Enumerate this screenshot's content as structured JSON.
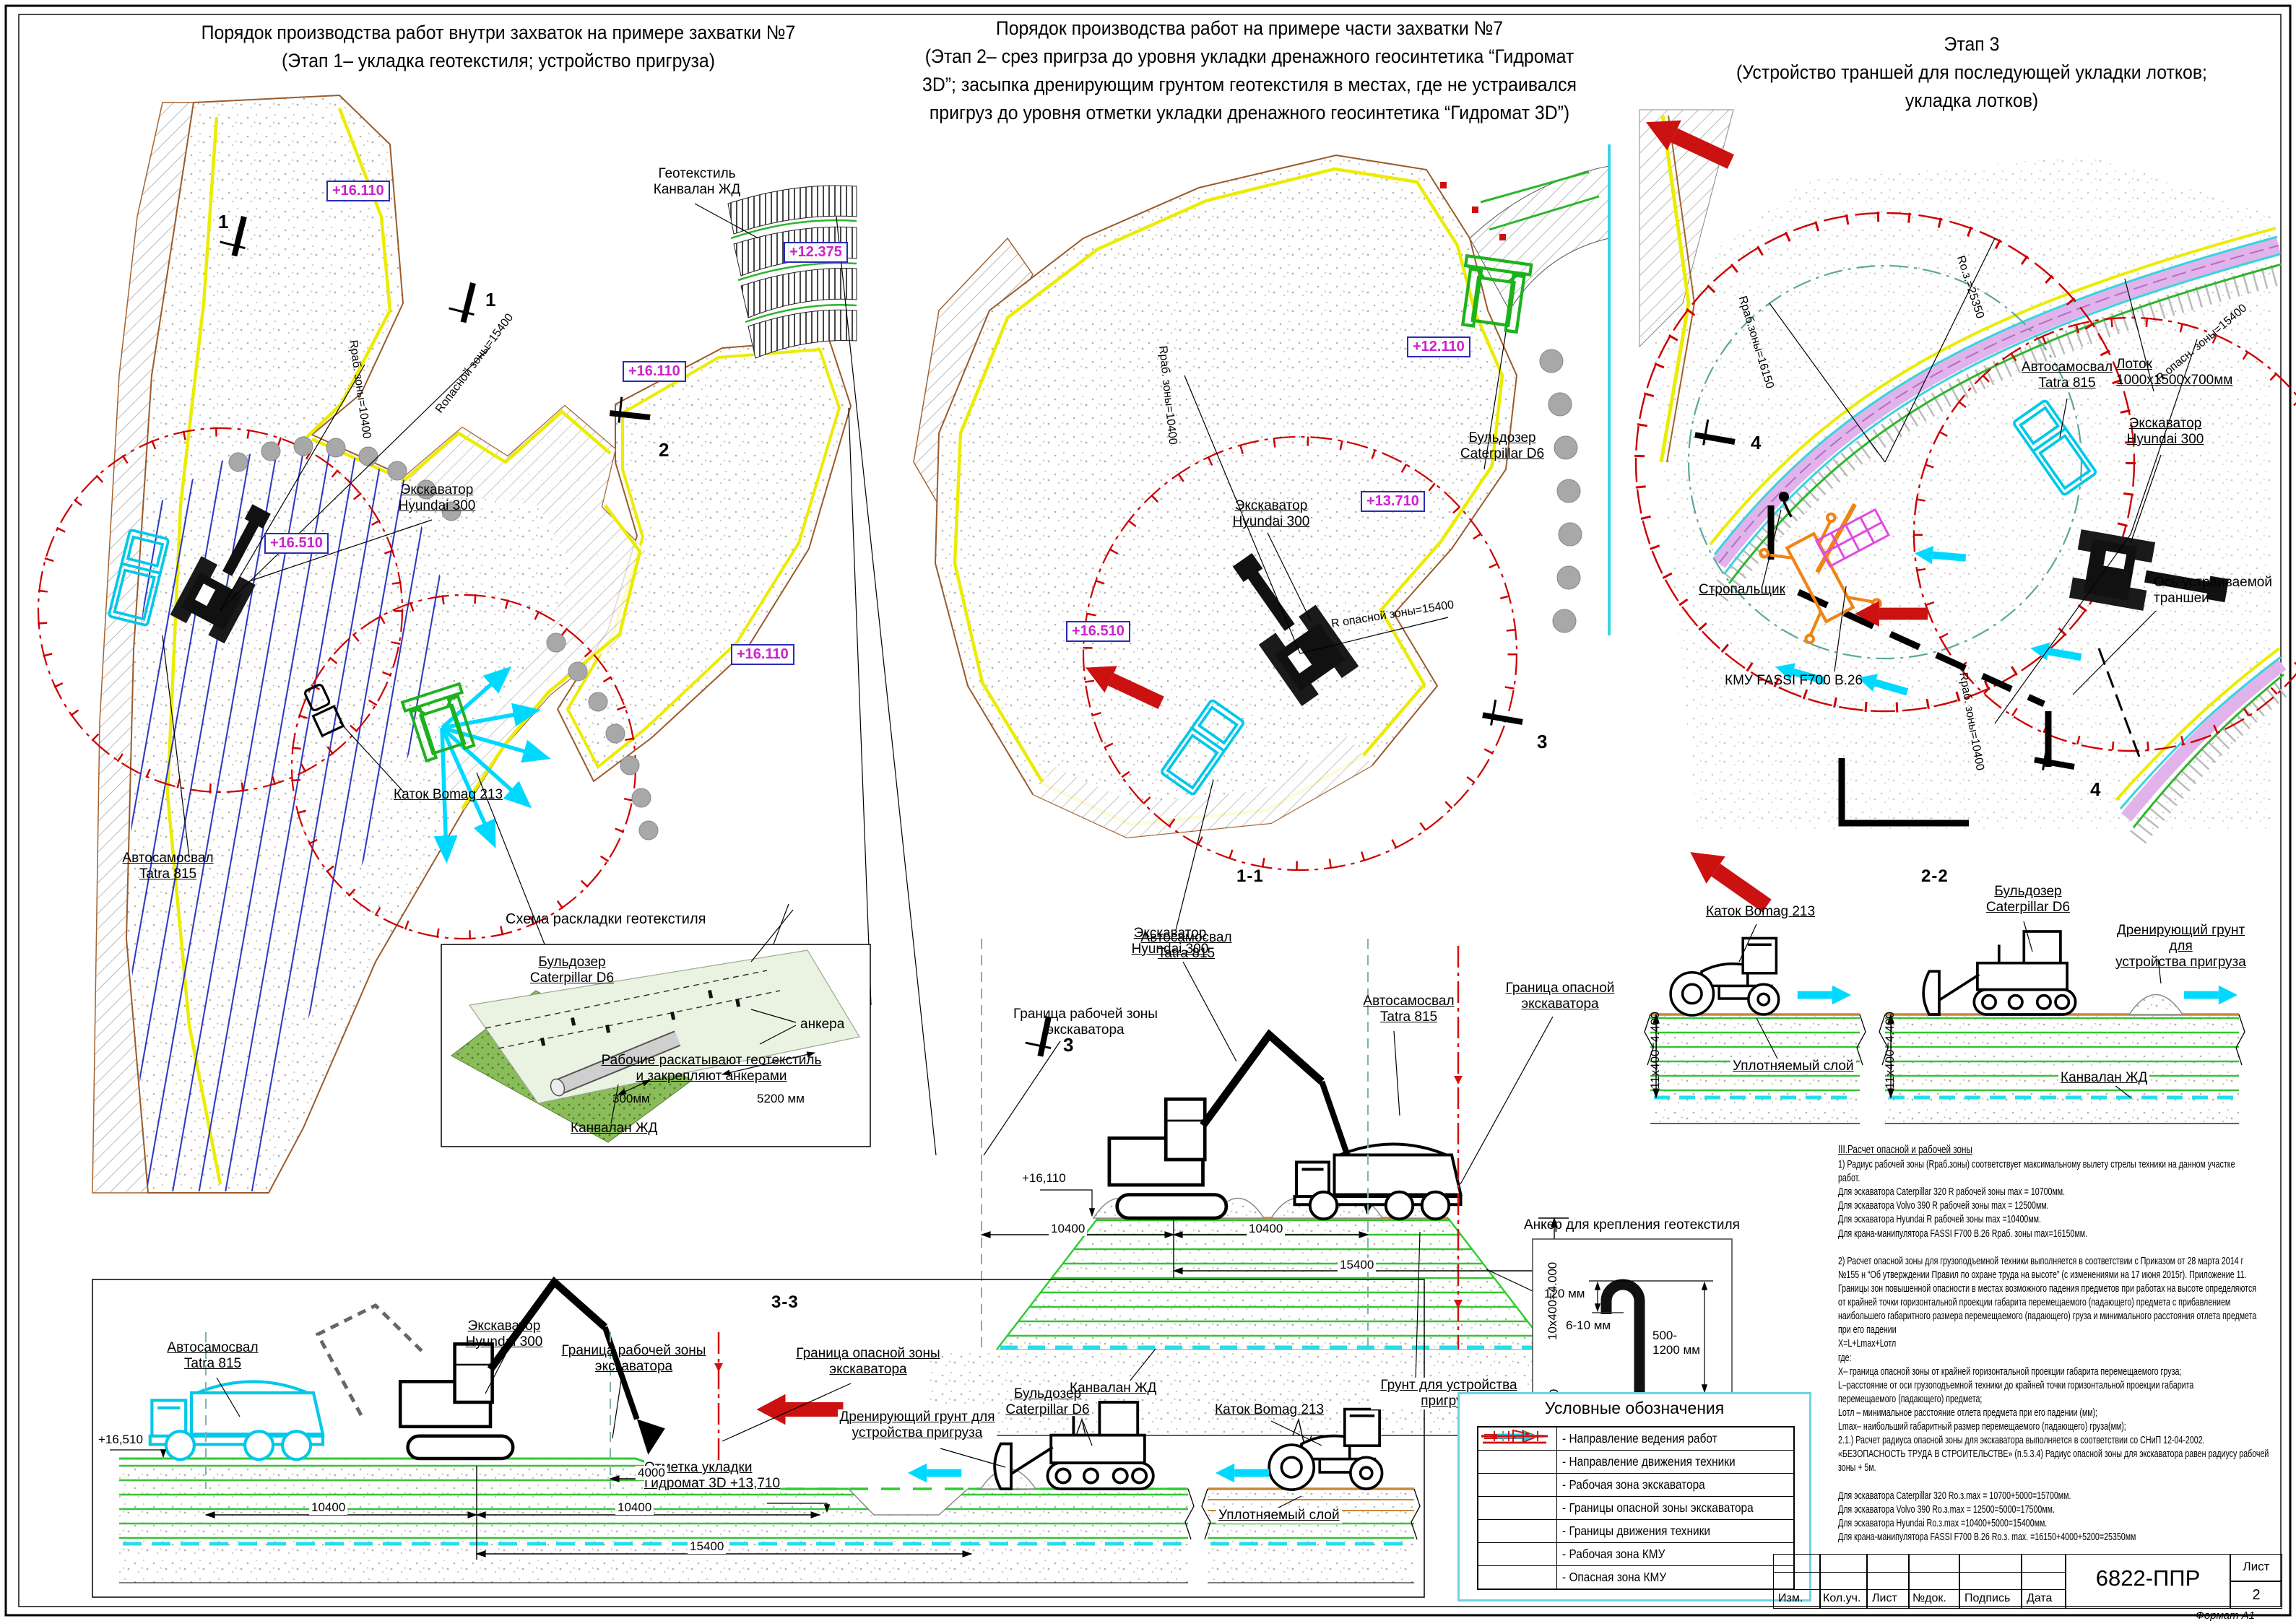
{
  "titles": {
    "t1": "Порядок производства работ внутри захваток на примере захватки №7\n(Этап 1– укладка геотекстиля; устройство пригруза)",
    "t2": "Порядок производства работ  на примере части захватки №7\n(Этап 2– срез пригрза до уровня укладки дренажного геосинтетика “Гидромат\n3D”; засыпка дренирующим грунтом геотекстиля в местах, где не устраивался\nпригруз до уровня отметки укладки дренажного геосинтетика “Гидромат 3D”)",
    "t3": "Этап 3\n(Устройство траншей для последующей укладки  лотков;\nукладка лотков)"
  },
  "plan1": {
    "e1": "+16.110",
    "e2": "+12.375",
    "e3": "+16.110",
    "e4": "+16.510",
    "e5": "+16.110",
    "geotextile": "Геотекстиль\nКанвалан ЖД",
    "excavator": "Экскаватор\nHyundai 300",
    "r_rab": "Rраб. зоны=10400",
    "r_opasn": "Rопасной зоны=15400",
    "truck": "Автосамосвал\nTatra 815",
    "dozer": "Бульдозер\nCaterpillar D6",
    "roller": "Каток Bomag 213",
    "workers": "Рабочие раскатывают геотекстиль\nи закрепляют анкерами",
    "m1a": "1",
    "m1b": "1",
    "m2": "2"
  },
  "inset": {
    "title": "Схема раскладки геотекстиля",
    "anchors": "анкера",
    "dim300": "300мм",
    "dim5200": "5200 мм",
    "kanvalan": "Канвалан ЖД"
  },
  "plan2": {
    "e1": "+12.110",
    "e2": "+13.710",
    "e3": "+16.510",
    "dozer": "Бульдозер\nCaterpillar D6",
    "excavator": "Экскаватор\nHyundai 300",
    "truck": "Автосамосвал\nTatra 815",
    "r_rab": "Rраб. зоны=10400",
    "r_opasn": "R опасной зоны=15400",
    "m3a": "3",
    "m3b": "3"
  },
  "plan3": {
    "truck": "Автосамосвал\nTatra 815",
    "lotok": "Лоток\n1000х1500х700мм",
    "excavator": "Экскаватор\nHyundai 300",
    "stropal": "Стропальщик",
    "kmu": "КМУ FASSI F700 B.26",
    "axis": "Ось устраиваемой\nтраншеи",
    "r_rab16150": "Rраб.зоны=16150",
    "r_oz25350": "Rо.з.=25350",
    "r_opasn15400": "R опасн. зоны=15400",
    "r_rab10400": "Rраб. зоны=10400",
    "m4a": "4",
    "m4b": "4"
  },
  "sec11": {
    "title": "1-1",
    "excavator": "Экскаватор\nHyundai 300",
    "truck": "Автосамосвал\nTatra 815",
    "gr_rab": "Граница рабочей зоны\nэкскаватора",
    "gr_opasn": "Граница опасной\nэкскаватора",
    "elev": "+16,110",
    "d1": "10400",
    "d2": "10400",
    "d3": "15400",
    "dv": "10х400=4.000",
    "d300": "300",
    "kanvalan": "Канвалан ЖД",
    "grunt": "Грунт для устройства\nпригруза"
  },
  "sec22": {
    "title": "2-2",
    "roller": "Каток Bomag 213",
    "dozer": "Бульдозер\nCaterpillar D6",
    "dren": "Дренирующий грунт для\nустройства пригруза",
    "uplotn": "Уплотняемый слой",
    "kanvalan": "Канвалан ЖД",
    "dvl": "11х400=4.400",
    "dvr": "11х400=4.400"
  },
  "sec33": {
    "title": "3-3",
    "truck": "Автосамосвал\nTatra 815",
    "excavator": "Экскаватор\nHyundai 300",
    "gr_rab": "Граница рабочей зоны\nэкскаватора",
    "gr_opasn": "Граница опасной зоны\nэкскаватора",
    "elev": "+16,510",
    "otmetka": "Отметка укладки\nГидромат 3D   +13,710",
    "d4000": "4000",
    "d1": "10400",
    "d2": "10400",
    "d3": "15400",
    "dozer": "Бульдозер\nCaterpillar D6",
    "roller": "Каток Bomag 213",
    "dren": "Дренирующий грунт для\nустройства пригруза",
    "uplotn": "Уплотняемый слой"
  },
  "anchor_detail": {
    "title": "Анкер для крепления геотекстиля",
    "d120": "120  мм",
    "d610": "6-10 мм",
    "d500": "500-\n1200 мм"
  },
  "legend": {
    "title": "Условные обозначения",
    "items": [
      {
        "symbol": "work-direction-arrow",
        "label": "- Направление ведения работ"
      },
      {
        "symbol": "machine-move-arrow",
        "label": "- Направление движения техники"
      },
      {
        "symbol": "excavator-work-zone-dash",
        "label": "- Рабочая зона экскаватора"
      },
      {
        "symbol": "excavator-danger-flag",
        "label": "- Границы опасной зоны экскаватора"
      },
      {
        "symbol": "machine-borders-dash",
        "label": "- Границы движения техники"
      },
      {
        "symbol": "kmu-work-zone-dashdot",
        "label": "- Рабочая зона КМУ"
      },
      {
        "symbol": "kmu-danger-crossline",
        "label": "- Опасная зона КМУ"
      }
    ],
    "colors": {
      "work_direction": "#cc1111",
      "machine_move": "#00d9ff",
      "exc_zone": "#69a396",
      "danger": "#cc0000",
      "borders": "#2ecc2e"
    }
  },
  "notes": {
    "heading": "III.Расчет опасной и рабочей зоны",
    "body": "1) Радиус рабочей зоны (Rраб.зоны) соответствует максимальному вылету стрелы техники на данном участке\nработ.\nДля эскаватора Caterpillar 320 R рабочей зоны max = 10700мм.\nДля эскаватора Volvo 390 R рабочей зоны max = 12500мм.\nДля эскаватора Hyundai R рабочей зоны max =10400мм.\nДля крана-манипулятора FASSI F700 B.26 Rраб. зоны max=16150мм.\n\n2) Расчет опасной зоны для грузоподъемной техники выполняется в соответствии с Приказом от 28 марта 2014 г\n№155 н “Об утверждении Правил по охране труда на высоте” (с изменениями на 17 июня 2015г). Приложение 11.\nГраницы зон повышенной опасности в местах возможного падения предметов при работах на высоте определяются\nот крайней точки горизонтальной проекции габарита перемещаемого (падающего) предмета с прибавлением\nнаибольшего габаритного размера перемещаемого (падающего) груза и минимального расстояния отлета предмета\nпри его падении\nX=L+Lmax+Lотл\nгде:\nX– граница опасной зоны от крайней горизонтальной проекции габарита перемещаемого груза;\nL–расстояние от оси грузоподъемной техники до крайней точки горизонтальной проекции габарита\nперемещаемого (падающего) предмета;\nLотл – минимальное расстояние отлета предмета при его падении (мм);\nLmax– наибольший габаритный размер перемещаемого (падающего) груза(мм);\n2.1.) Расчет радиуса опасной зоны для экскаватора выполняется в соответствии со СНиП 12-04-2002.\n«БЕЗОПАСНОСТЬ ТРУДА В СТРОИТЕЛЬСТВЕ» (п.5.3.4) Радиус опасной зоны для экскаватора равен радиусу рабочей\nзоны + 5м.\n\nДля эскаватора Caterpillar 320 Rо.з.max = 10700+5000=15700мм.\nДля эскаватора Volvo 390 Rо.з.max = 12500=5000=17500мм.\nДля эскаватора Hyundai Rо.з.max =10400+5000=15400мм.\nДля крана-манипулятора FASSI F700 B.26 Rо.з. max. =16150+4000+5200=25350мм"
  },
  "titleblock": {
    "doc": "6822-ППР",
    "sheet_label": "Лист",
    "sheet_no": "2",
    "format": "Формат А1",
    "cols": [
      "Изм.",
      "Кол.уч.",
      "Лист",
      "№док.",
      "Подпись",
      "Дата"
    ]
  }
}
